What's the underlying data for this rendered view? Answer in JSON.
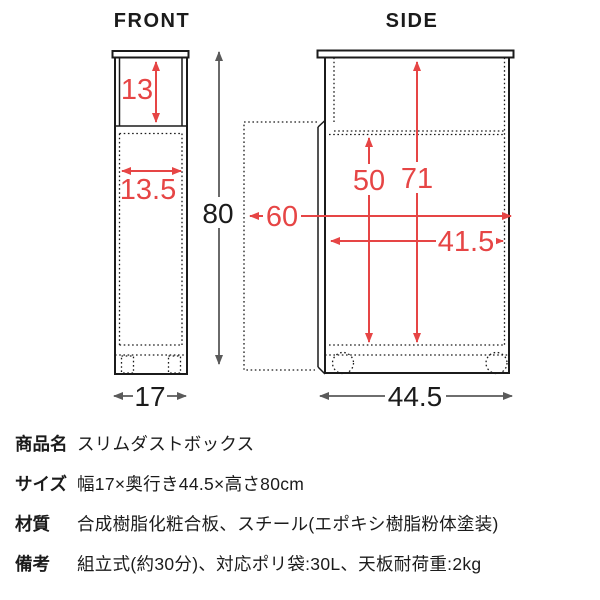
{
  "diagram": {
    "front": {
      "title": "FRONT",
      "opening_height": "13",
      "inner_width": "13.5",
      "width": "17"
    },
    "side": {
      "title": "SIDE",
      "bag_height": "50",
      "inner_height": "71",
      "depth_with_door_open": "60",
      "inner_depth": "41.5",
      "depth": "44.5"
    },
    "height": "80",
    "colors": {
      "dimension_red": "#e64545",
      "dimension_gray": "#5a5a5a",
      "outline_black": "#1b1b1b"
    }
  },
  "specs": {
    "rows": [
      {
        "label": "商品名",
        "value": "スリムダストボックス"
      },
      {
        "label": "サイズ",
        "value": "幅17×奥行き44.5×高さ80cm"
      },
      {
        "label": "材質",
        "value": "合成樹脂化粧合板、スチール(エポキシ樹脂粉体塗装)"
      },
      {
        "label": "備考",
        "value": "組立式(約30分)、対応ポリ袋:30L、天板耐荷重:2kg"
      }
    ]
  }
}
